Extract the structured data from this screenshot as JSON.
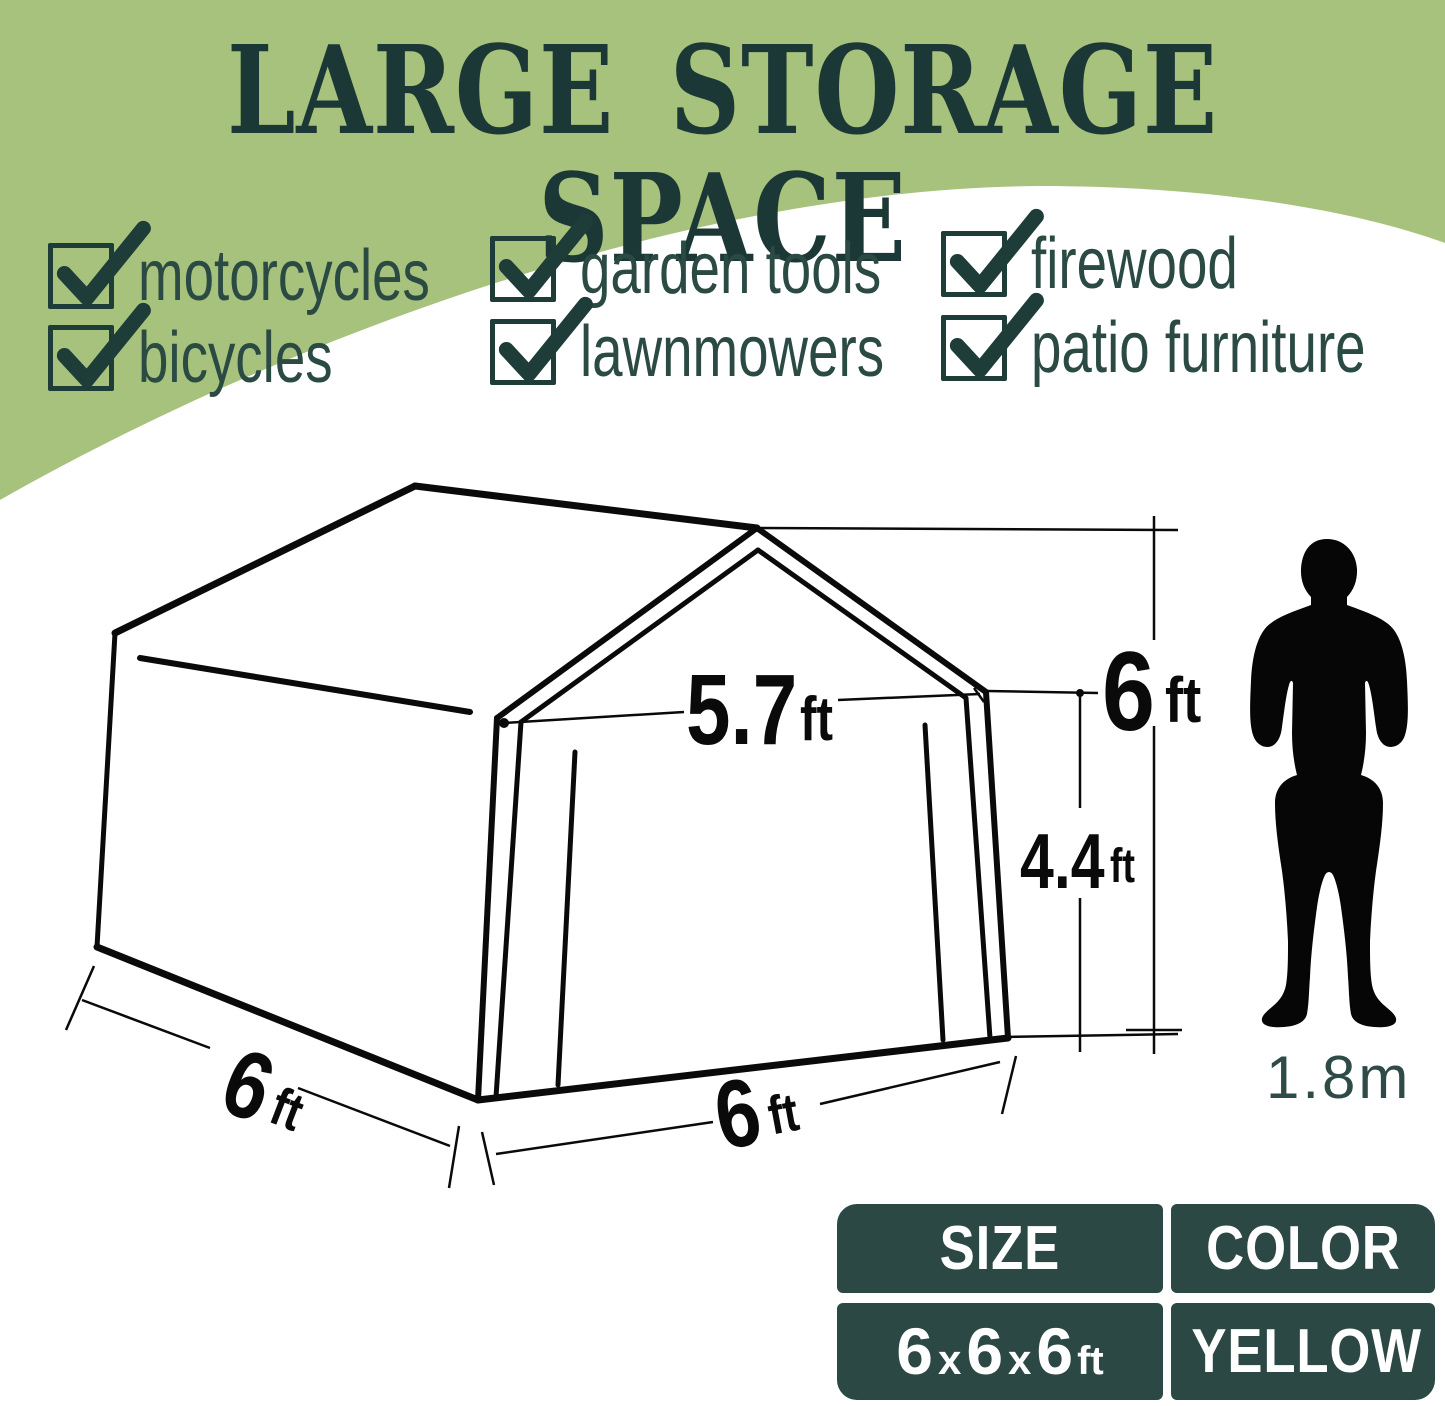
{
  "title": "LARGE STORAGE SPACE",
  "features": [
    "motorcycles",
    "garden tools",
    "firewood",
    "bicycles",
    "lawnmowers",
    "patio furniture"
  ],
  "diagram": {
    "gable_width_value": "5.7",
    "gable_width_unit": "ft",
    "total_height_value": "6",
    "total_height_unit": "ft",
    "wall_height_value": "4.4",
    "wall_height_unit": "ft",
    "depth_value": "6",
    "depth_unit": "ft",
    "front_width_value": "6",
    "front_width_unit": "ft",
    "person_height": "1.8m"
  },
  "spec_table": {
    "size_header": "SIZE",
    "color_header": "COLOR",
    "size_value_parts": [
      "6",
      "x",
      "6",
      "x",
      "6",
      "ft"
    ],
    "color_value": "YELLOW"
  },
  "colors": {
    "background_green": "#a7c27c",
    "title_teal": "#1c3836",
    "checkbox_teal": "#1e3c38",
    "feature_text": "#2b4a44",
    "table_background": "#2c4845",
    "table_text": "#ffffff",
    "line_black": "#0a0a0a",
    "person_height_text": "#2e4b47"
  }
}
